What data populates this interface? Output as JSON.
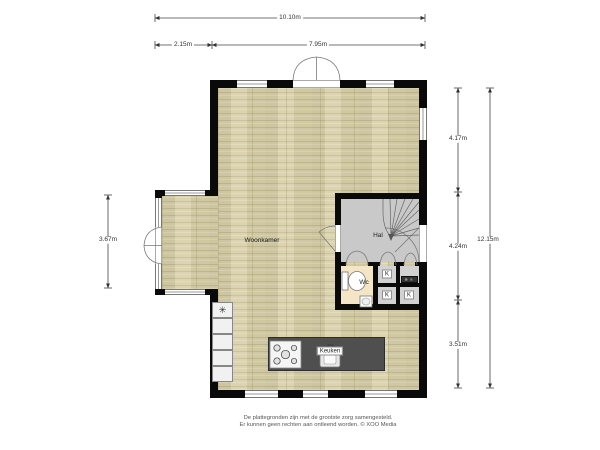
{
  "plan": {
    "rooms": {
      "living": "Woonkamer",
      "hall": "Hal",
      "toilet": "Wc",
      "kitchen": "Keuken",
      "closet": "K"
    },
    "fridge_symbol": "✳",
    "dimensions": {
      "top_total": "10.10m",
      "top_bay": "2.15m",
      "top_main": "7.95m",
      "left_bay": "3.67m",
      "right_top": "4.17m",
      "right_middle": "4.24m",
      "right_bottom": "3.51m",
      "right_total": "12.15m"
    },
    "footer": {
      "line1": "De plattegronden zijn met de grootste zorg samengesteld.",
      "line2": "Er kunnen geen rechten aan ontleend worden. © XOO Media"
    },
    "colors": {
      "wall": "#0a0a0a",
      "floor_wood": "#d8d0a8",
      "floor_hall": "#c9c9c9",
      "floor_wc": "#f3e5c6",
      "kitchen_island": "#4f4f4f"
    }
  }
}
